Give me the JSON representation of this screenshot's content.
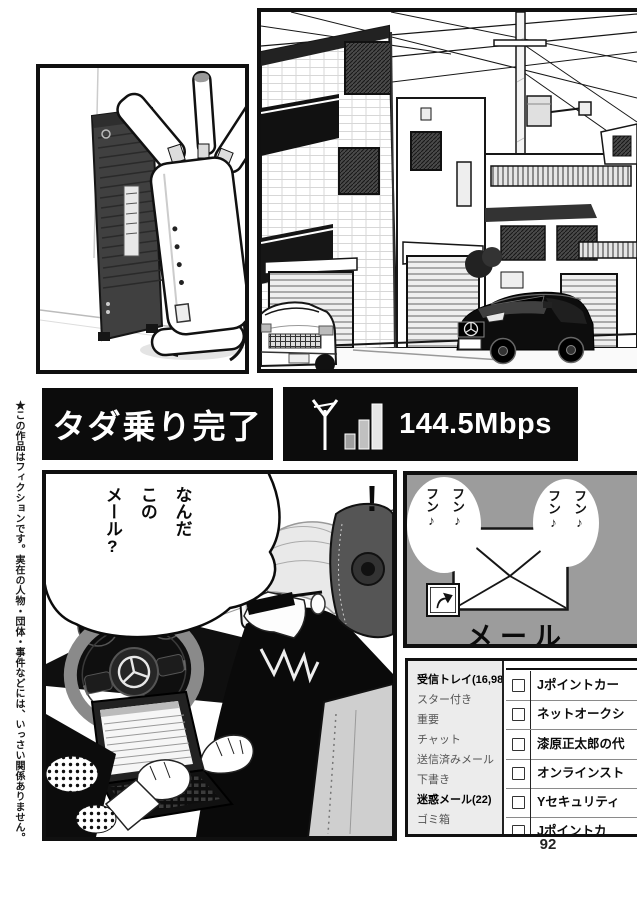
{
  "page": {
    "number": "92",
    "disclaimer": "★この作品はフィクションです。実在の人物・団体・事件などには、いっさい関係ありません。"
  },
  "banner": {
    "title": "タダ乗り完了",
    "speed": "144.5Mbps",
    "signal_icon": "antenna-signal-bars-icon"
  },
  "car_panel": {
    "bubble": "なんだ\nこの\nメール?",
    "exclamation": "!"
  },
  "mail_panel": {
    "label": "メール",
    "humming_left": "フン♪\nフン♪",
    "humming_right": "フン♪\nフン♪",
    "envelope_icon": "envelope-icon",
    "shortcut_icon": "shortcut-arrow-icon",
    "background_color": "#9c9c9c"
  },
  "email_app": {
    "sidebar": [
      {
        "label": "受信トレイ(16,984)",
        "bold": true
      },
      {
        "label": "スター付き",
        "bold": false
      },
      {
        "label": "重要",
        "bold": false
      },
      {
        "label": "チャット",
        "bold": false
      },
      {
        "label": "送信済みメール",
        "bold": false
      },
      {
        "label": "下書き",
        "bold": false
      },
      {
        "label": "迷惑メール(22)",
        "bold": true
      },
      {
        "label": "ゴミ箱",
        "bold": false
      }
    ],
    "rows": [
      "Jポイントカー",
      "ネットオークシ",
      "漆原正太郎の代",
      "オンラインスト",
      "Yセキュリティ",
      "Jポイントカ"
    ]
  },
  "colors": {
    "ink": "#111111",
    "panel_gray": "#9c9c9c",
    "sidebar_gray": "#ececec"
  }
}
